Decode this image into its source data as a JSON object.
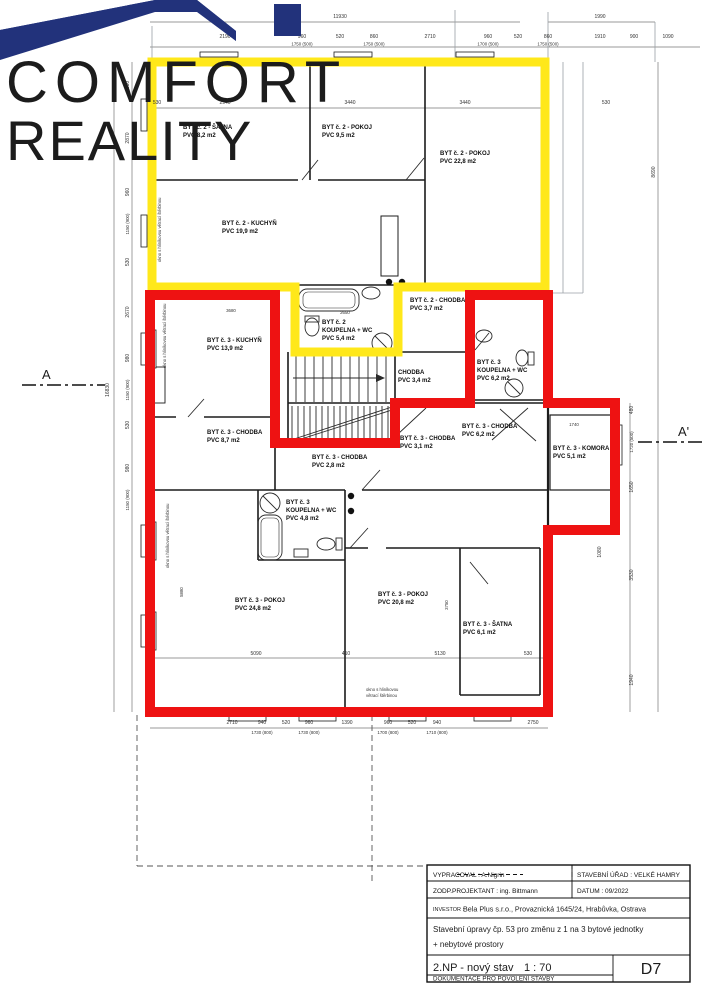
{
  "logo": {
    "line1": "COMFORT",
    "line2": "REALITY",
    "navy": "#22327B",
    "blue": "#4C87F0"
  },
  "outlines": {
    "unit2_color": "#FFE81A",
    "unit3_color": "#EE1212"
  },
  "section_markers": {
    "left": "A",
    "right": "A'"
  },
  "rooms": [
    {
      "n": "BYT č. 2 - ŠATNA",
      "a": "PVC 8,2 m2"
    },
    {
      "n": "BYT č. 2 - POKOJ",
      "a": "PVC 9,5 m2"
    },
    {
      "n": "BYT č. 2 - POKOJ",
      "a": "PVC 22,8 m2"
    },
    {
      "n": "BYT č. 2 - KUCHYŇ",
      "a": "PVC 19,9 m2"
    },
    {
      "n": "BYT č. 2",
      "n2": "KOUPELNA + WC",
      "a": "PVC 5,4 m2"
    },
    {
      "n": "BYT č. 2 - CHODBA",
      "a": "PVC 3,7 m2"
    },
    {
      "n": "BYT č. 3 - KUCHYŇ",
      "a": "PVC 13,9 m2"
    },
    {
      "n": "CHODBA",
      "a": "PVC 3,4 m2"
    },
    {
      "n": "BYT č. 3",
      "n2": "KOUPELNA + WC",
      "a": "PVC 6,2 m2"
    },
    {
      "n": "BYT č. 3 - CHODBA",
      "a": "PVC 8,7 m2"
    },
    {
      "n": "BYT č. 3 - CHODBA",
      "a": "PVC 2,8 m2"
    },
    {
      "n": "BYT č. 3 - CHODBA",
      "a": "PVC 3,1 m2"
    },
    {
      "n": "BYT č. 3 - CHODBA",
      "a": "PVC 6,2 m2"
    },
    {
      "n": "BYT č. 3 - KOMORA",
      "a": "PVC 5,1 m2"
    },
    {
      "n": "BYT č. 3",
      "n2": "KOUPELNA + WC",
      "a": "PVC 4,8 m2"
    },
    {
      "n": "BYT č. 3 - POKOJ",
      "a": "PVC 24,8 m2"
    },
    {
      "n": "BYT č. 3 - POKOJ",
      "a": "PVC 20,8 m2"
    },
    {
      "n": "BYT č. 3 - ŠATNA",
      "a": "PVC 6,1 m2"
    }
  ],
  "annotations": {
    "window_note": "okno s hliníkovou větrací štěrbinou",
    "window_note_l1": "okno s hliníkovou",
    "window_note_l2": "větrací štěrbinou"
  },
  "dims": {
    "total_width": "11930",
    "right_width": "1990",
    "top": [
      "2190",
      "960",
      "1750 (500)",
      "520",
      "860",
      "1750 (500)",
      "2710",
      "960",
      "1700 (500)",
      "520",
      "860",
      "1750 (500)",
      "1910",
      "900",
      "1090"
    ],
    "inner_top": [
      "530",
      "2940",
      "3440",
      "3440",
      "530"
    ],
    "bottom": [
      "2710",
      "940",
      "1730 (800)",
      "520",
      "960",
      "1730 (800)",
      "1390",
      "960",
      "1700 (800)",
      "520",
      "940",
      "1710 (800)",
      "2750"
    ],
    "left": [
      "530",
      "2870",
      "960",
      "1150 (900)",
      "530",
      "2670",
      "980",
      "1150 (900)",
      "530",
      "980",
      "1150 (900)",
      "16830"
    ],
    "right": [
      "8690",
      "480",
      "1720 (500)",
      "1650",
      "3530",
      "1940",
      "1080"
    ],
    "interior": [
      "2650",
      "3680",
      "1740",
      "5090",
      "410",
      "5130",
      "530",
      "5880",
      "3750"
    ]
  },
  "title_block": {
    "vypracoval": "VYPRACOVAL : A.Nigrin",
    "urad": "STAVEBNÍ ÚŘAD : VELKÉ HAMRY",
    "projektant": "ZODP.PROJEKTANT : ing. Bittmann",
    "datum": "DATUM : 09/2022",
    "investor_label": "INVESTOR :",
    "investor": "Bela Plus s.r.o., Provaznická 1645/24, Hrabůvka, Ostrava",
    "nazev1": "Stavební úpravy čp. 53 pro změnu z 1 na 3 bytové  jednotky",
    "nazev2": "+ nebytové prostory",
    "vykres": "2.NP - nový stav",
    "meritko": "1 : 70",
    "faze": "DOKUMENTACE PRO POVOLENÍ STAVBY",
    "cislo": "D7"
  }
}
